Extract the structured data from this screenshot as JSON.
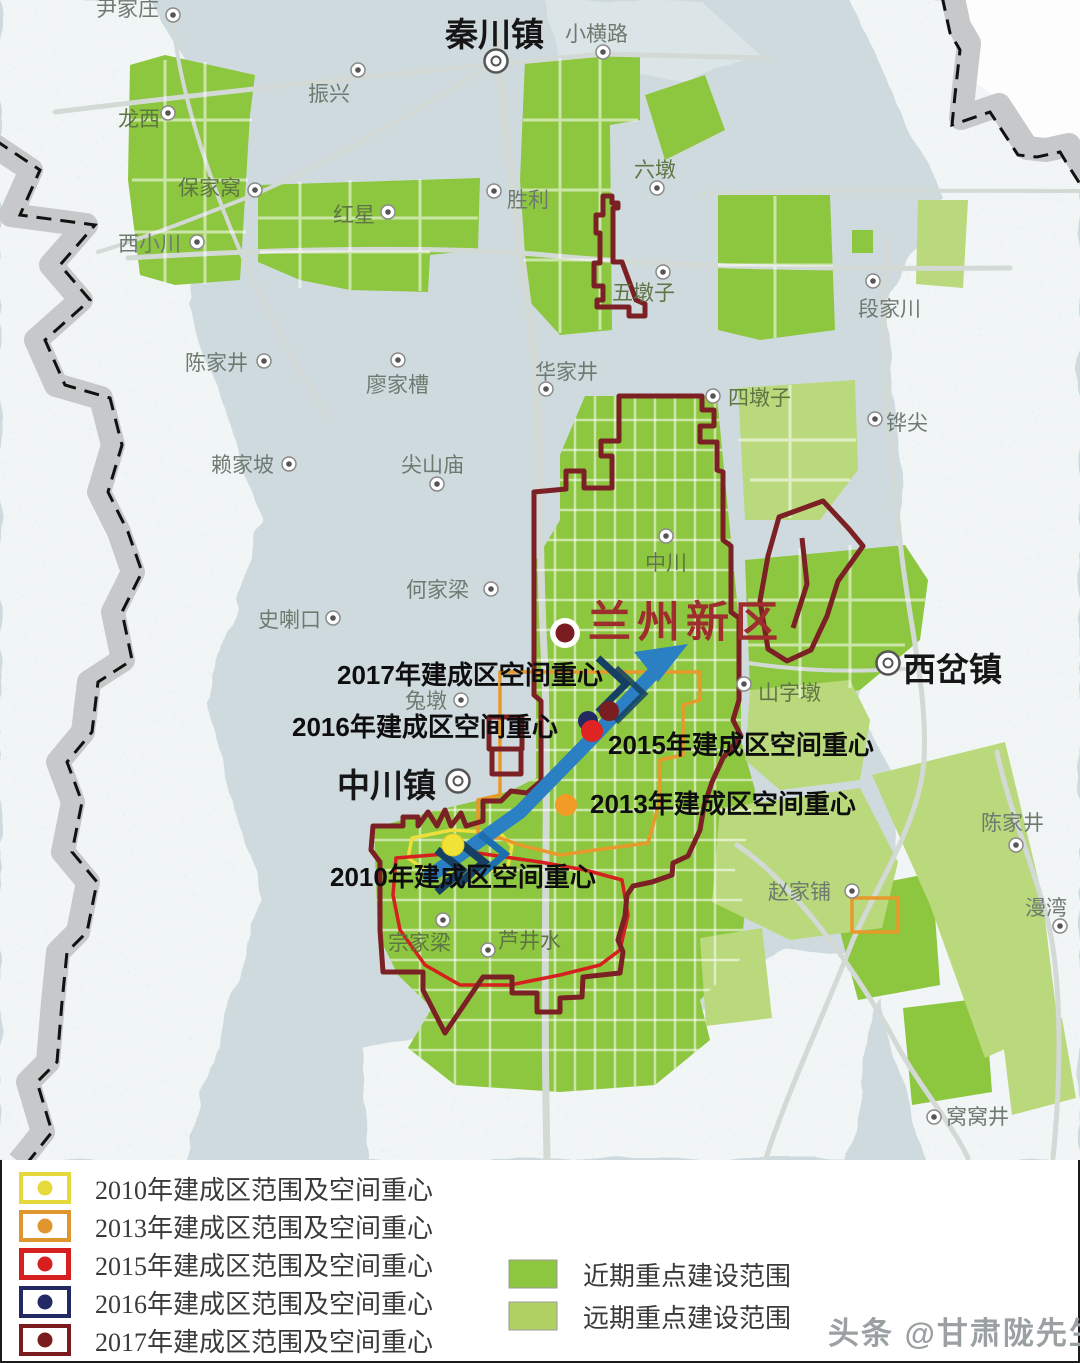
{
  "colors": {
    "mapBg": "#cfdade",
    "terrain": "#e3ecec",
    "nearGreen": "#8dc63f",
    "farGreen": "#b9d97c",
    "maroon": "#7b2125",
    "red15": "#d61f1f",
    "orange13": "#e8992b",
    "yellow10": "#ecdf3e",
    "navy16": "#232a63",
    "maroon17": "#7b1d20",
    "titleRed": "#9e2d2d",
    "arrowBlue": "#2b7fc3",
    "arrowDark": "#153f63",
    "road": "#d3d9d5",
    "grayBand": "#c6c8c9",
    "textGray": "#6e7a70",
    "textGreen": "#5e7544"
  },
  "map": {
    "city_label": "兰州新区",
    "towns": [
      {
        "name": "秦川镇"
      },
      {
        "name": "中川镇"
      },
      {
        "name": "西岔镇"
      }
    ],
    "places": [
      {
        "name": "尹家庄"
      },
      {
        "name": "龙西"
      },
      {
        "name": "振兴"
      },
      {
        "name": "保家窝"
      },
      {
        "name": "红星"
      },
      {
        "name": "西小川"
      },
      {
        "name": "小横路"
      },
      {
        "name": "六墩"
      },
      {
        "name": "胜利"
      },
      {
        "name": "五墩子"
      },
      {
        "name": "段家川"
      },
      {
        "name": "陈家井"
      },
      {
        "name": "廖家槽"
      },
      {
        "name": "华家井"
      },
      {
        "name": "赖家坡"
      },
      {
        "name": "尖山庙"
      },
      {
        "name": "四墩子"
      },
      {
        "name": "铧尖"
      },
      {
        "name": "中川"
      },
      {
        "name": "何家梁"
      },
      {
        "name": "史喇口"
      },
      {
        "name": "兔墩"
      },
      {
        "name": "山字墩"
      },
      {
        "name": "陈家井"
      },
      {
        "name": "漫湾"
      },
      {
        "name": "赵家铺"
      },
      {
        "name": "宗家梁"
      },
      {
        "name": "芦井水"
      },
      {
        "name": "窝窝井"
      }
    ],
    "center_labels": {
      "y2017": "2017年建成区空间重心",
      "y2016": "2016年建成区空间重心",
      "y2015": "2015年建成区空间重心",
      "y2013": "2013年建成区空间重心",
      "y2010": "2010年建成区空间重心"
    }
  },
  "legend": {
    "years": [
      {
        "label": "2010年建成区范围及空间重心",
        "color": "#e6d93c"
      },
      {
        "label": "2013年建成区范围及空间重心",
        "color": "#e0962e"
      },
      {
        "label": "2015年建成区范围及空间重心",
        "color": "#d61f1f"
      },
      {
        "label": "2016年建成区范围及空间重心",
        "color": "#232a63"
      },
      {
        "label": "2017年建成区范围及空间重心",
        "color": "#7b1d20"
      }
    ],
    "areas": [
      {
        "label": "近期重点建设范围",
        "color": "#8dc63f"
      },
      {
        "label": "远期重点建设范围",
        "color": "#afd163"
      }
    ]
  },
  "watermark": "头条 @甘肃陇先生"
}
